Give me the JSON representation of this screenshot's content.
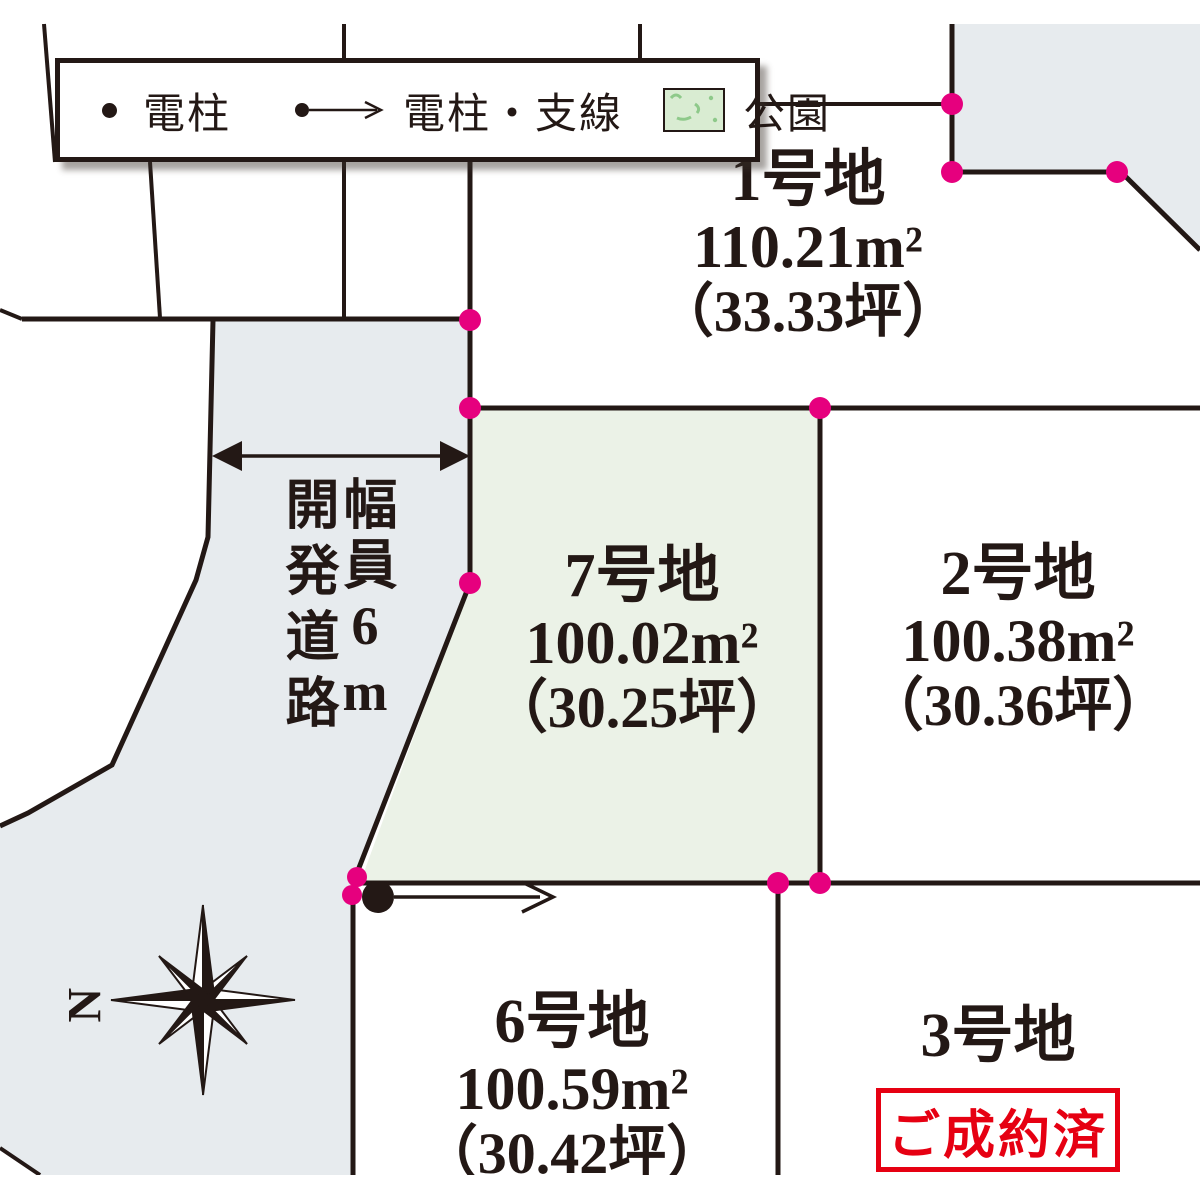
{
  "legend": {
    "items": [
      {
        "icon": "pole-dot",
        "label": "電柱"
      },
      {
        "icon": "pole-arrow",
        "label": "電柱・支線"
      },
      {
        "icon": "park-swatch",
        "label": "公園"
      }
    ]
  },
  "road": {
    "name_vertical": "開発道路",
    "width_vertical": "幅員6m"
  },
  "compass": {
    "north_label": "N"
  },
  "lots": {
    "lot1": {
      "name": "1号地",
      "area": "110.21m²",
      "tsubo": "（33.33坪）"
    },
    "lot2": {
      "name": "2号地",
      "area": "100.38m²",
      "tsubo": "（30.36坪）"
    },
    "lot7": {
      "name": "7号地",
      "area": "100.02m²",
      "tsubo": "（30.25坪）"
    },
    "lot6": {
      "name": "6号地",
      "area": "100.59m²",
      "tsubo": "（30.42坪）"
    },
    "lot3": {
      "name": "3号地",
      "status": "ご成約済"
    }
  },
  "colors": {
    "ink": "#231815",
    "road_fill": "#e7ebee",
    "lot7_fill": "#ebf2e7",
    "park_fill": "#d9ecd2",
    "park_mark": "#8ec98a",
    "boundary_dot": "#e6007e",
    "sold_red": "#e60012"
  }
}
